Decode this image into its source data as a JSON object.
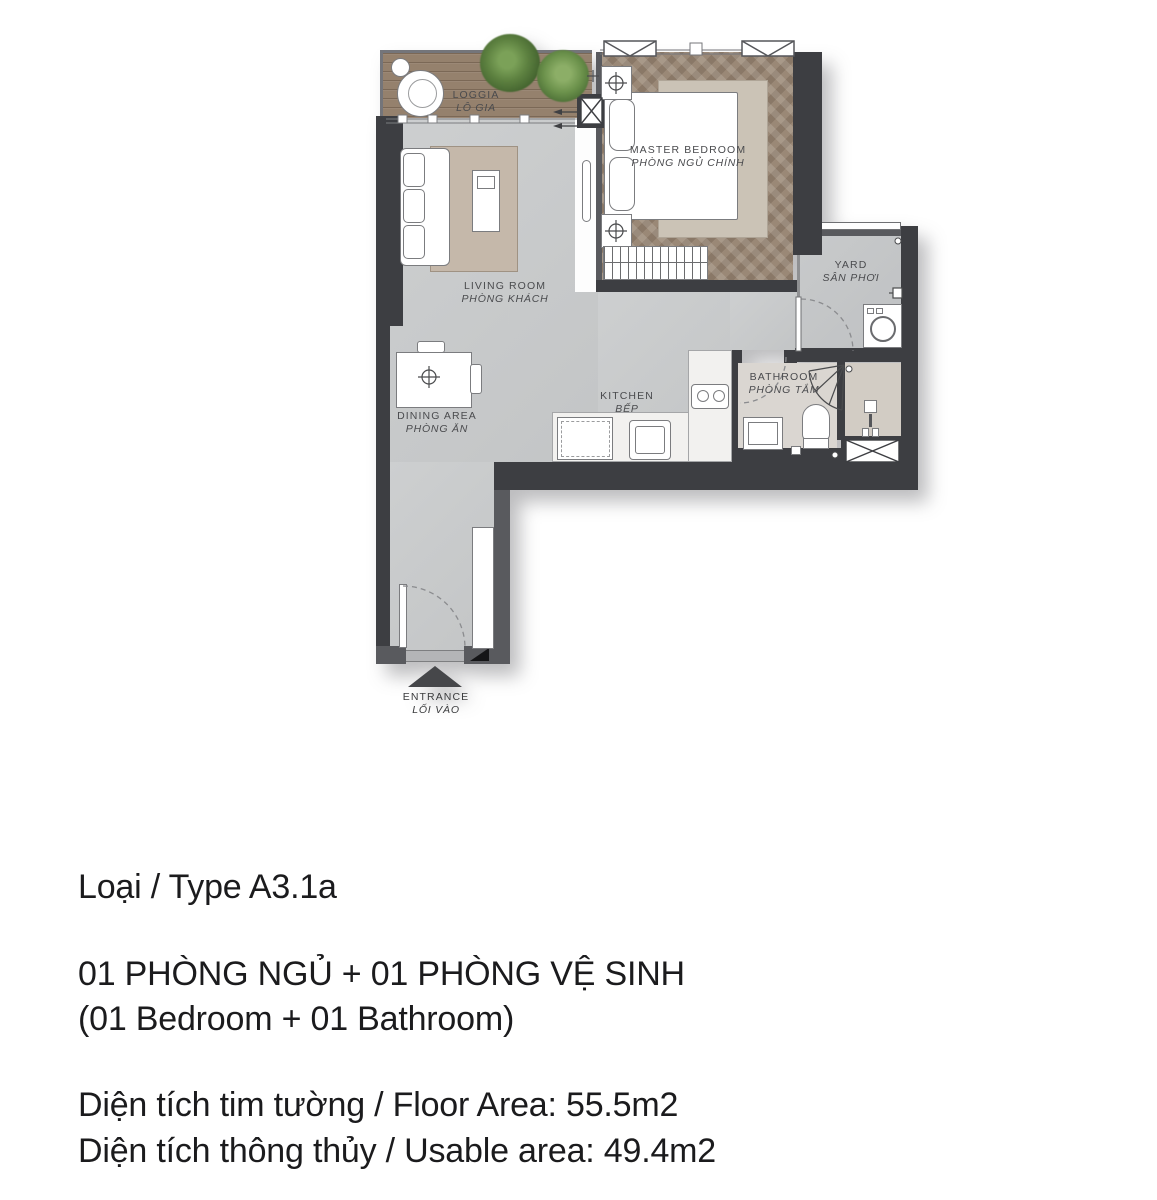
{
  "floor_plan": {
    "rooms": [
      {
        "name": "LOGGIA",
        "name_vi": "LÔ GIA"
      },
      {
        "name": "MASTER BEDROOM",
        "name_vi": "PHÒNG NGỦ CHÍNH"
      },
      {
        "name": "LIVING ROOM",
        "name_vi": "PHÒNG KHÁCH"
      },
      {
        "name": "DINING AREA",
        "name_vi": "PHÒNG ĂN"
      },
      {
        "name": "KITCHEN",
        "name_vi": "BẾP"
      },
      {
        "name": "YARD",
        "name_vi": "SÂN PHƠI"
      },
      {
        "name": "BATHROOM",
        "name_vi": "PHÒNG TẮM"
      },
      {
        "name": "ENTRANCE",
        "name_vi": "LỐI VÀO"
      }
    ],
    "colors": {
      "wall": "#3d3e42",
      "floor_main": "#c8cacb",
      "floor_loggia_wood": "#95816d",
      "floor_bedroom_wood": "#9a8876",
      "floor_bathroom": "#dad6d1",
      "plant_green": "#5d8140"
    }
  },
  "unit_info": {
    "type": "Loại / Type A3.1a",
    "layout_vi": "01 PHÒNG NGỦ + 01 PHÒNG VỆ SINH",
    "layout_en": "(01 Bedroom + 01 Bathroom)",
    "floor_area": "Diện tích tim tường / Floor Area: 55.5m2",
    "usable_area": "Diện tích thông thủy / Usable area: 49.4m2"
  }
}
